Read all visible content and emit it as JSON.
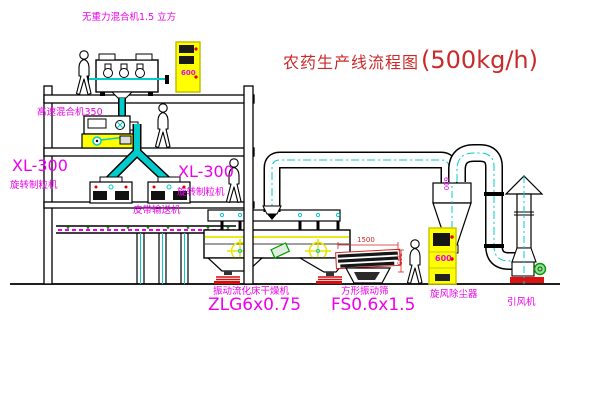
{
  "title": {
    "name": "农药生产线流程图",
    "capacity": "(500kg/h)"
  },
  "labels": {
    "mixer_top": "无重力混合机1.5 立方",
    "mixer_mid": "高速混合机350",
    "xl_left_model": "XL-300",
    "xl_left_name": "旋转制粒机",
    "xl_right_model": "XL-300",
    "xl_right_name": "旋转制粒机",
    "belt_conveyor": "皮带输送机",
    "dryer_name": "振动流化床干燥机",
    "dryer_model": "ZLG6x0.75",
    "sieve_name": "方形振动筛",
    "sieve_model": "FS0.6x1.5",
    "cyclone_name": "旋风除尘器",
    "fan_name": "引风机"
  },
  "dims": {
    "sieve_length": "1500",
    "sieve_height": "345",
    "cyclone": "600",
    "cabinet_top": "600",
    "cabinet_right": "600"
  },
  "colors": {
    "label_magenta": "#ee00ee",
    "title_red": "#cb2a2a",
    "centerline_cyan": "#00cccc",
    "cabinet_yellow": "#ffff00",
    "line_black": "#000000",
    "status_green": "#009900",
    "spring_red": "#d11111"
  }
}
